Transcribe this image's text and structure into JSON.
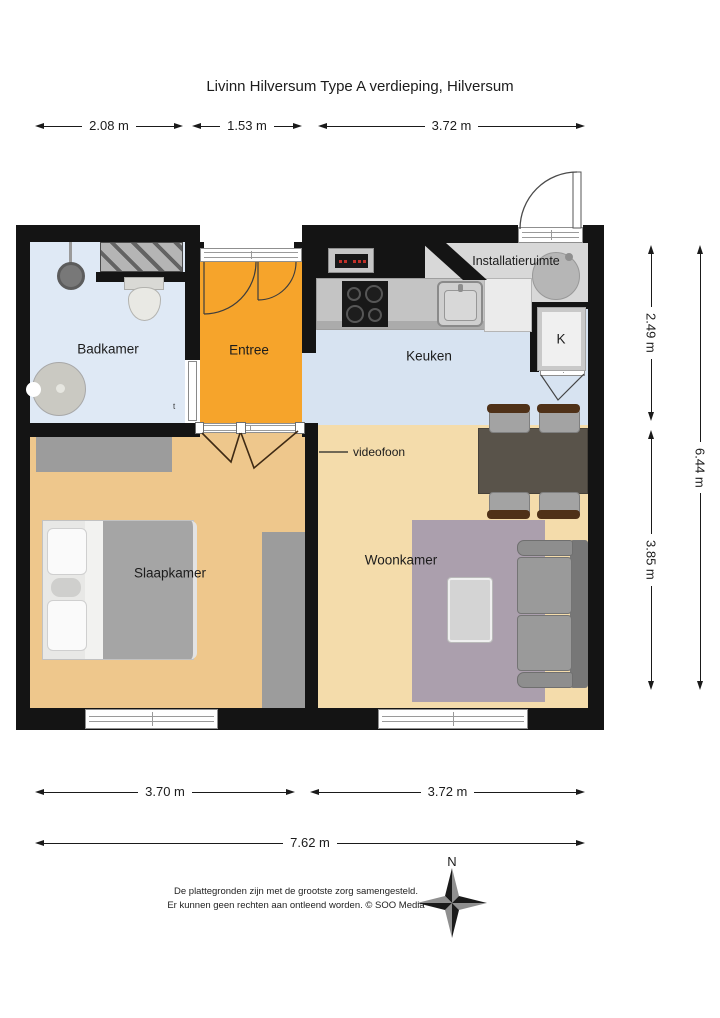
{
  "title": "Livinn Hilversum Type A verdieping, Hilversum",
  "dimensions": {
    "top": [
      "2.08 m",
      "1.53 m",
      "3.72 m"
    ],
    "right": [
      "2.49 m",
      "3.85 m",
      "6.44 m"
    ],
    "bottom": [
      "3.70 m",
      "3.72 m",
      "7.62 m"
    ]
  },
  "rooms": {
    "badkamer": {
      "label": "Badkamer"
    },
    "entree": {
      "label": "Entree"
    },
    "keuken": {
      "label": "Keuken"
    },
    "installatieruimte": {
      "label": "Installatieruimte"
    },
    "slaapkamer": {
      "label": "Slaapkamer"
    },
    "woonkamer": {
      "label": "Woonkamer"
    }
  },
  "annotations": {
    "videofoon": "videofoon",
    "closet_k": "K",
    "thermostat": "t",
    "compass_north": "N"
  },
  "footer": {
    "line1": "De plattegronden zijn met de grootste zorg samengesteld.",
    "line2": "Er kunnen geen rechten aan ontleend worden. © SOO Media"
  },
  "colors": {
    "wall": "#141414",
    "badkamer_floor": "#dfe9f5",
    "keuken_floor": "#d7e3f1",
    "entree_floor": "#f6a42b",
    "slaapkamer_floor": "#eec78c",
    "woonkamer_floor": "#f4dcab",
    "installatieruimte_floor": "#d8d8d8",
    "rug": "#ab9fad",
    "sofa": "#8f8f8f",
    "dining_table": "#59534a",
    "chair_back": "#4f3118",
    "bed_blanket": "#a5a5a5",
    "closet_gray": "#9c9c9c"
  }
}
